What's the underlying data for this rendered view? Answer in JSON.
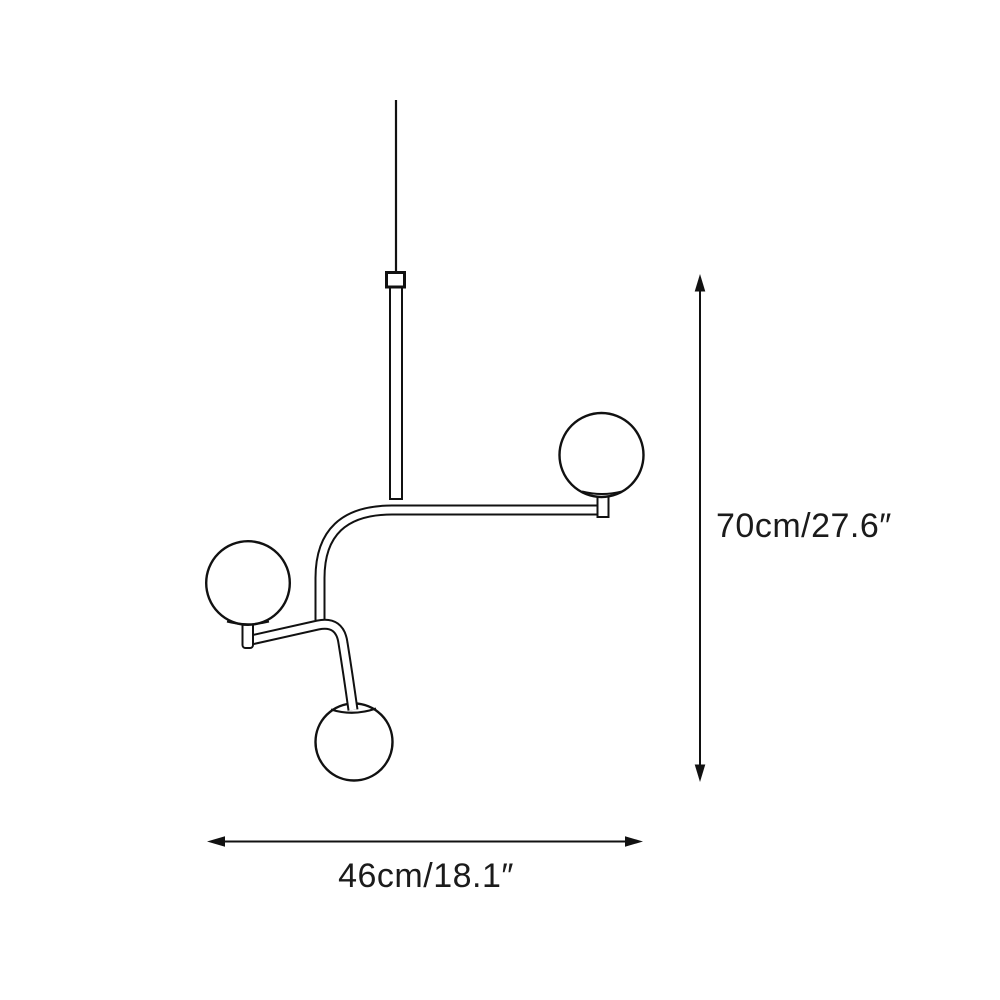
{
  "diagram": {
    "labels": {
      "height_dimension": "70cm/27.6″",
      "width_dimension": "46cm/18.1″"
    },
    "colors": {
      "ink": "#111111",
      "text": "#1b1b1b",
      "background": "#ffffff"
    }
  }
}
